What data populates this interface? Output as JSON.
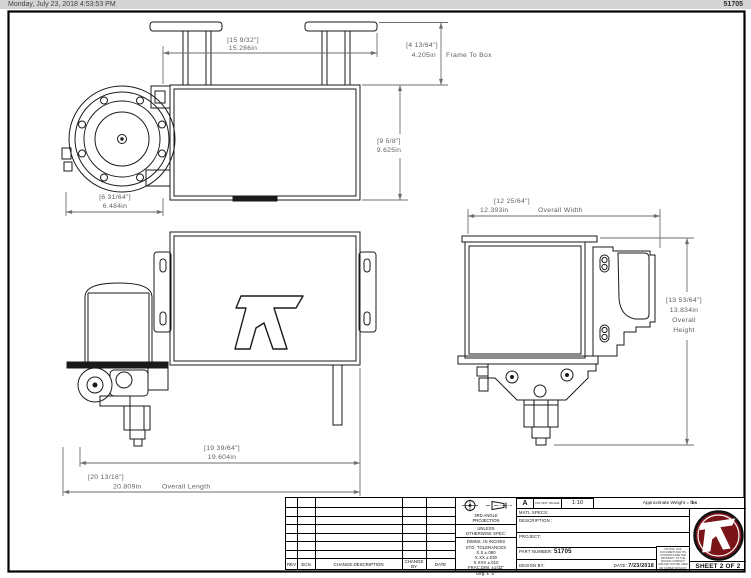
{
  "header": {
    "timestamp": "Monday, July 23, 2018 4:53:53 PM",
    "doc_number": "51705"
  },
  "dimensions": {
    "frame_width": {
      "fraction": "[15 9/32\"]",
      "decimal": "15.286in"
    },
    "frame_to_box": {
      "fraction": "[4 13/64\"]",
      "decimal": "4.205in",
      "note": "Frame To Box"
    },
    "box_depth": {
      "fraction": "[9 5/8\"]",
      "decimal": "9.625in"
    },
    "motor_length": {
      "fraction": "[6 31/64\"]",
      "decimal": "6.484in"
    },
    "overall_width": {
      "fraction": "[12 25/64\"]",
      "decimal": "12.393in",
      "note": "Overall Width"
    },
    "overall_height": {
      "fraction": "[13 53/64\"]",
      "decimal": "13.834in",
      "note_line1": "Overall",
      "note_line2": "Height"
    },
    "tank_length": {
      "fraction": "[19 39/64\"]",
      "decimal": "19.604in"
    },
    "overall_length": {
      "fraction": "[20 13/16\"]",
      "decimal": "20.809in",
      "note": "Overall Length"
    }
  },
  "title_block": {
    "revision_table": {
      "headers": {
        "rev": "REV",
        "ecn": "ECN",
        "change_description": "CHANGE DESCRIPTION",
        "change_by_1": "CHANGE",
        "change_by_2": "BY",
        "date": "DATE"
      }
    },
    "projection_line1": "3RD ANGLE",
    "projection_line2": "PROJECTION",
    "tolerances": [
      "UNLESS",
      "OTHERWISE SPEC:",
      "DIMNS. IN INCHES",
      "STD. TOLERANCES",
      "X.X ±.060",
      "X.XX ±.030",
      "X.XXX ±.010",
      "FRAC.DIM. ±1/32\"",
      "Deg. ± .5°"
    ],
    "size": "A",
    "do_not_scale": "DO NOT SCALE DRAWING",
    "scale": "1:10",
    "weight_label": "Approximate Weight = ",
    "weight_unit": "lbs",
    "matl_specs_label": "MATL SPECS:",
    "description_label": "DESCRIPTION :",
    "project_label": "PROJECT:",
    "part_number_label": "PART NUMBER: ",
    "part_number": "51705",
    "design_by_label": "DESIGN BY:",
    "date_label": "DATE: ",
    "date_value": "7/23/2018",
    "notice": "NOTICE: THIS DOCUMENT AND ITS CONTENTS ARE THE PROPERTY OF THE ISSUING COMPANY AND MAY NOT BE USED OR COPIED WITHOUT WRITTEN PERMISSION.",
    "sheet_label": "SHEET 2 OF 2"
  },
  "colors": {
    "logo_maroon": "#7a1418",
    "line": "#1a1a1a",
    "dim_gray": "#6e6e6e",
    "header_bar": "#d4d4d4"
  }
}
